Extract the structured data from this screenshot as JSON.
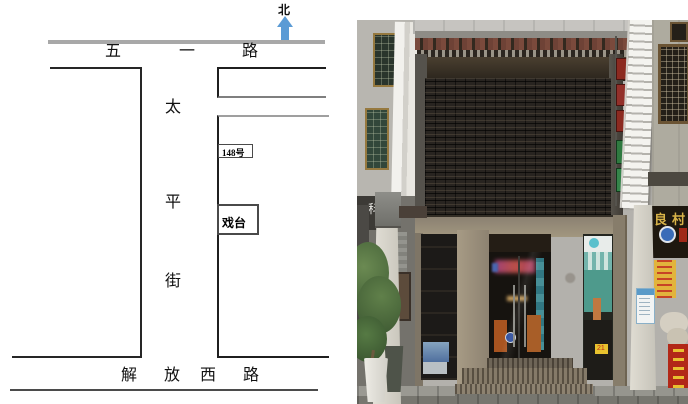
{
  "map": {
    "north_label": "北",
    "road_top": [
      "五",
      "一",
      "路"
    ],
    "street_vertical": [
      "太",
      "平",
      "街"
    ],
    "road_bottom": [
      "解",
      "放",
      "西",
      "路"
    ],
    "house_number": "148号",
    "stage_label": "戏台",
    "colors": {
      "north_arrow_blue": "#5b9bd5",
      "road_gray": "#a8a8a8",
      "outline_black": "#262626",
      "outline_gray": "#9f9f9f"
    }
  },
  "photo": {
    "left_shop_char": "科",
    "right_shop_sign": "良村",
    "price_tag": "21",
    "colors": {
      "shutter_dark": "#282420",
      "roof_tile_red": "#7a4a3c",
      "storefront_beige": "#998e7b",
      "wall_gray": "#b6b4ae",
      "white_sign": "#f0efeb",
      "liangcun_bg": "#1e180f",
      "liangcun_text": "#d8b348",
      "yellow_sign": "#e2b43c",
      "red_sign": "#b22818",
      "green_sign": "#2f7a40",
      "teal_sign": "#5ac0cc"
    }
  }
}
